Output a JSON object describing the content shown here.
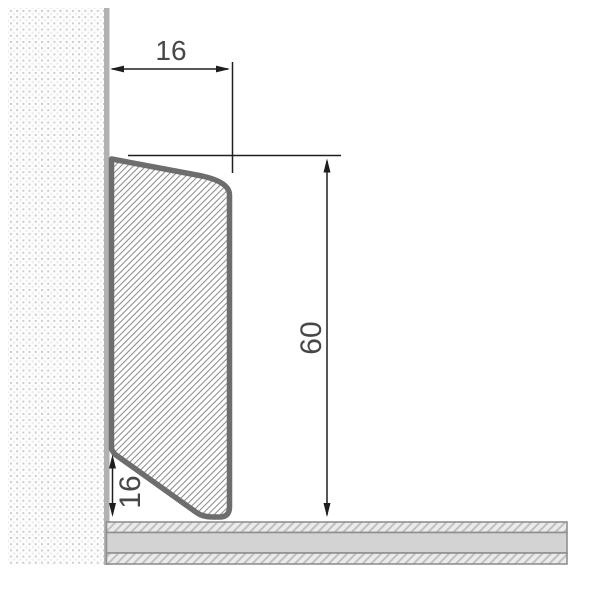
{
  "diagram": {
    "dimension_labels": {
      "top_width": "16",
      "height": "60",
      "bottom_height": "16"
    },
    "colors": {
      "background": "#ffffff",
      "profile_outline": "#6d6d6d",
      "profile_hatch_line": "#8d8d8d",
      "wall_dot_dark": "#cbcbcb",
      "wall_dot_light": "#e9e9e9",
      "wall_edge_band": "#b2b2b2",
      "floor_band_fill": "#d3d3d3",
      "floor_hatch_bg": "#ebebeb",
      "floor_hatch_line": "#c0c0c0",
      "floor_border": "#909090",
      "dimension_line": "#1e1e1e",
      "dimension_text": "#474747"
    }
  }
}
